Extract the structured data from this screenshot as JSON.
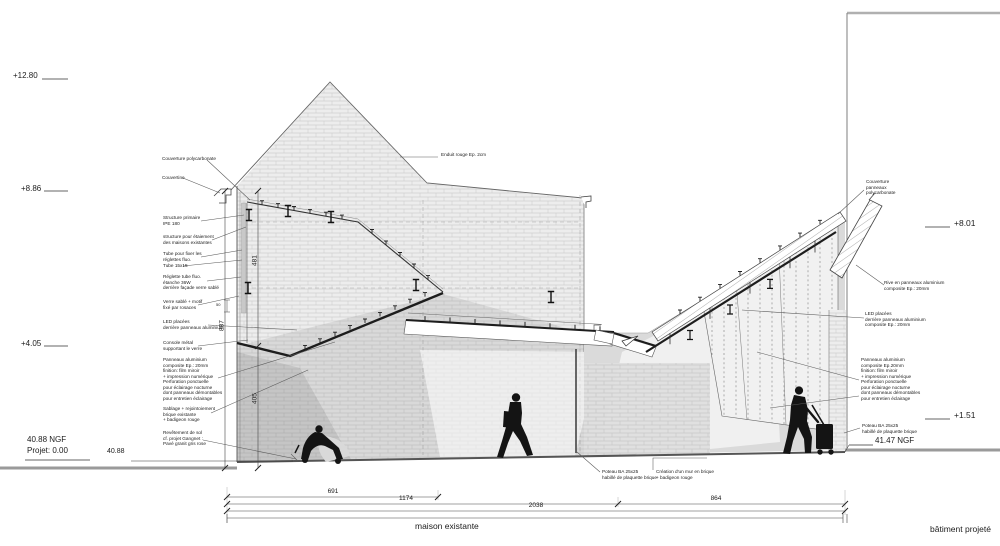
{
  "drawing": {
    "type": "architectural cross-section",
    "zones": {
      "left": "maison existante",
      "right": "bâtiment projeté"
    },
    "elevations_left": {
      "top": "+12.80",
      "eave": "+8.86",
      "mid": "+4.05",
      "ngf": "40.88 NGF\nProjet: 0.00",
      "ground": "40.88"
    },
    "elevations_right": {
      "canopy": "+8.01",
      "low": "+1.51",
      "ngf": "41.47 NGF"
    },
    "dimensions": {
      "v_upper": "481",
      "v_total": "887",
      "v_lower": "405",
      "h_1": "691",
      "h_2": "1174",
      "h_3": "2038",
      "h_4": "864",
      "detail": "50"
    },
    "callouts_left": {
      "couverture_polycarbonate": "Couverture polycarbonate",
      "couvertine": "Couvertine",
      "structure_primaire": "Structure primaire\nIPE 180",
      "structure_etaiement": "structure pour étaiement\ndes maisons existantes",
      "tube_fixation": "Tube pour fixer les\nréglettes fluo.",
      "tube_15x15": "Tube 15x15",
      "reglette_fluo": "Réglette tube fluo.\nétanche 36W\nderrière façade verre sablé",
      "verre_sable": "Verre sablé + motif\nfixé par rosaces",
      "led": "LED placées\nderrière panneaux aluminium",
      "console": "Console métal\nsupportant le verre",
      "panneaux_aluminium": "Panneaux aluminium\ncomposite Ep.: 20mm\nfinition: film miroir\n+ impression numérique\nPerforation ponctuelle\npour éclairage nocturne\ndont panneaux démontables\npour entretien éclairage",
      "sablage": "Sablage + rejointoiement\nbrique existante\n+ badigeon rouge",
      "revetement": "Revêtement de sol\ncf. projet Gangnet :\nPavé granit gris rose"
    },
    "callouts_center": {
      "enduit": "Enduit rouge Ep. 2cm",
      "poteau": "Poteau BA 25x25\nhabillé de plaquette brique",
      "creation_mur": "Création d'un mur en brique\n+ badigeon rouge"
    },
    "callouts_right": {
      "couverture": "Couverture\npanneaux\npolycarbonate",
      "rive": "Rive en panneaux aluminium\ncomposite Ep.: 20mm",
      "led": "LED placées\nderrière panneaux aluminium\ncomposite Ep.: 20mm",
      "panneaux_aluminium": "Panneaux aluminium\ncomposite Ep.20mm\nfinition: film miroir\n+ impression numérique\nPerforation ponctuelle\npour éclairage nocturne\ndont panneaux démontables\npour entretien éclairage",
      "poteau": "Poteau BA 25x25\nhabillé de plaquette brique"
    },
    "colors": {
      "line": "#333333",
      "wall": "#ececec",
      "shadow": "#c9c9c9",
      "ground": "#8f8f8f",
      "silhouette": "#141414"
    }
  }
}
